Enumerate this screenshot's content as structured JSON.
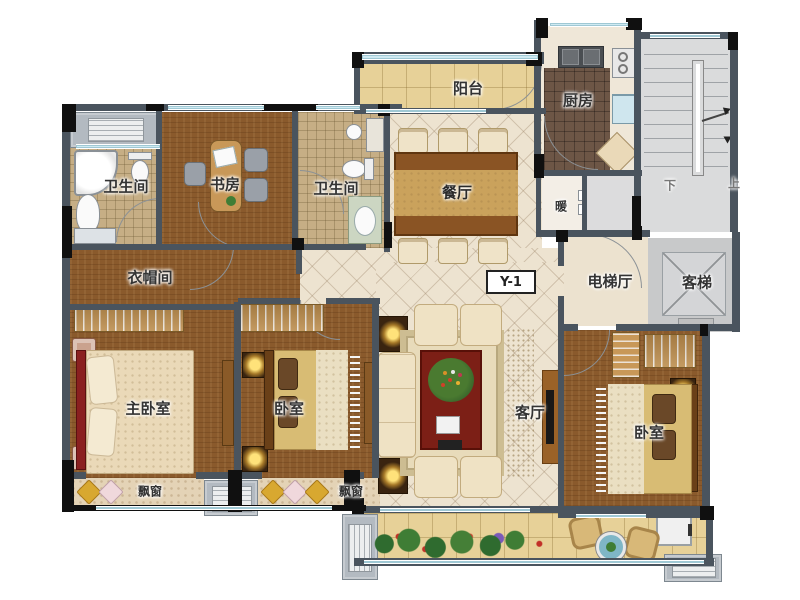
{
  "unit_code": "Y-1",
  "labels": {
    "bathroom_left": "卫生间",
    "study": "书房",
    "bathroom_mid": "卫生间",
    "balcony_top": "阳台",
    "kitchen": "厨房",
    "dining": "餐厅",
    "heating": "暖",
    "stairs_down": "下",
    "stairs_up": "上",
    "elevator_hall": "电梯厅",
    "elevator": "客梯",
    "cloakroom": "衣帽间",
    "master_bedroom": "主卧室",
    "bedroom_middle": "卧室",
    "living_room": "客厅",
    "bedroom_right": "卧室",
    "bay_window_left": "飘窗",
    "bay_window_middle": "飘窗"
  },
  "colors": {
    "wall": "#4a545e",
    "wall_black": "#101010",
    "wood_floor": "#8a5a2c",
    "bath_tile": "#c6ae85",
    "kitchen_tile": "#6d5646",
    "marble_floor": "#ede3d0",
    "balcony_tile": "#e7d198",
    "stairs_floor": "#d9dadb",
    "window_glass": "#cfeaf2",
    "coffee_table": "#7c1f16"
  }
}
